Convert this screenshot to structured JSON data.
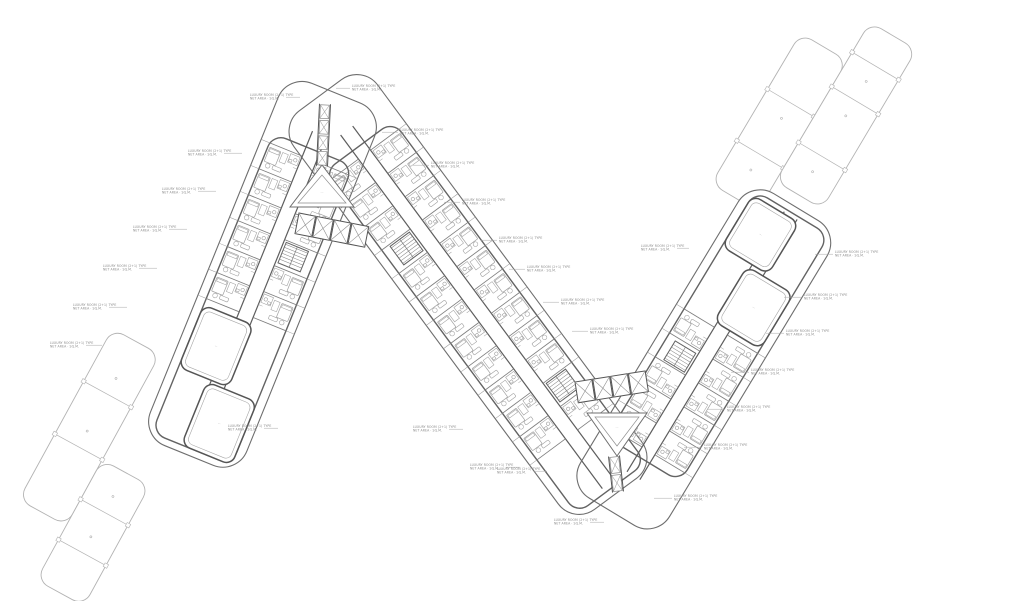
{
  "sheet": {
    "width": 1024,
    "height": 601,
    "background": "#ffffff",
    "kind": "residential-typical-floor-plan"
  },
  "palette": {
    "outline": "#6e6e6e",
    "wall": "#636363",
    "wall_heavy": "#555555",
    "corridor": "#5d5d5d",
    "partition": "#7e7e7e",
    "furniture": "#a0a0a0",
    "balcony": "#939393",
    "ghost": "#b3b3b3",
    "courtyard": "#6f6f6f",
    "annotation_text": "#8c8c8c",
    "leader": "#a8a8a8",
    "paper": "#ffffff"
  },
  "annotation_text": {
    "line1": "LUXURY ROOM (2+1) TYPE",
    "line2": "NET AREA · SQ.M."
  },
  "room_mark": "·–·",
  "ghosts": [
    {
      "id": "ghost-building-northeast",
      "origin": [
        762,
        208
      ],
      "angle": 210.7,
      "strips": [
        {
          "x": 2,
          "w": 54,
          "y0": -5,
          "y1": 170,
          "dividers": [
            45,
            105
          ]
        },
        {
          "x": -52,
          "w": 54,
          "y0": 30,
          "y1": 215,
          "dividers": [
            75,
            140,
            180
          ]
        }
      ]
    },
    {
      "id": "ghost-building-southwest",
      "origin": [
        140,
        395
      ],
      "angle": 28.7,
      "strips": [
        {
          "x": -56,
          "w": 54,
          "y0": -45,
          "y1": 150,
          "dividers": [
            15,
            75
          ]
        },
        {
          "x": -2,
          "w": 54,
          "y0": 75,
          "y1": 212,
          "dividers": [
            120,
            166
          ]
        }
      ]
    }
  ],
  "wings": [
    {
      "id": "middle-wing",
      "origin": [
        330,
        108
      ],
      "angle": -36.5,
      "length": 480,
      "half_width": 52,
      "corridor": [
        28,
        468
      ],
      "units": {
        "start": 58,
        "end": 406,
        "step": 29
      },
      "stairs": [
        {
          "side": -1,
          "t": 145
        },
        {
          "side": 1,
          "t": 348
        }
      ],
      "amenity": []
    },
    {
      "id": "left-wing",
      "origin": [
        330,
        108
      ],
      "angle": 22.09,
      "length": 375,
      "half_width": 52,
      "corridor": [
        28,
        363
      ],
      "units": {
        "start": 55,
        "end": 223,
        "step": 28
      },
      "stairs": [
        {
          "side": 1,
          "t": 148
        }
      ],
      "amenity": [
        {
          "x": -43,
          "y": 230,
          "w": 54,
          "h": 67
        },
        {
          "x": -11,
          "y": 300,
          "w": 54,
          "h": 68
        }
      ]
    },
    {
      "id": "right-wing",
      "origin": [
        620,
        498
      ],
      "angle": 211.15,
      "length": 340,
      "half_width": 52,
      "corridor": [
        26,
        330
      ],
      "units": {
        "start": 55,
        "end": 195,
        "step": 28
      },
      "stairs": [
        {
          "side": 1,
          "t": 150
        }
      ],
      "amenity": [
        {
          "x": -43,
          "y": 200,
          "w": 54,
          "h": 64
        },
        {
          "x": -11,
          "y": 268,
          "w": 54,
          "h": 60
        }
      ]
    }
  ],
  "junctions": [
    {
      "id": "top-junction-core",
      "triangle": [
        [
          322,
          165
        ],
        [
          290,
          207
        ],
        [
          354,
          207
        ]
      ],
      "triangle_inner": [
        [
          322,
          175
        ],
        [
          298,
          203
        ],
        [
          346,
          203
        ]
      ],
      "mark": [
        322,
        193
      ],
      "elevators": {
        "origin": [
          299,
          213
        ],
        "angle": 11,
        "count": 4,
        "w": 17,
        "h": 21,
        "gap": 1
      },
      "shaft": {
        "from": [
          325,
          104
        ],
        "to": [
          322,
          166
        ],
        "boxes": 4
      }
    },
    {
      "id": "bottom-junction-core",
      "triangle": [
        [
          617,
          456
        ],
        [
          587,
          413
        ],
        [
          647,
          413
        ]
      ],
      "triangle_inner": [
        [
          617,
          446
        ],
        [
          595,
          417
        ],
        [
          639,
          417
        ]
      ],
      "mark": [
        617,
        428
      ],
      "elevators": {
        "origin": [
          575,
          382
        ],
        "angle": -9,
        "count": 4,
        "w": 17,
        "h": 21,
        "gap": 1
      },
      "shaft": {
        "from": [
          614,
          456
        ],
        "to": [
          618,
          492
        ],
        "boxes": 2
      }
    }
  ],
  "annotations": [
    {
      "x": 250,
      "y": 96,
      "dir": "R",
      "len": 14
    },
    {
      "x": 188,
      "y": 152,
      "dir": "R",
      "len": 18
    },
    {
      "x": 162,
      "y": 190,
      "dir": "R",
      "len": 18
    },
    {
      "x": 133,
      "y": 228,
      "dir": "R",
      "len": 18
    },
    {
      "x": 103,
      "y": 267,
      "dir": "R",
      "len": 18
    },
    {
      "x": 73,
      "y": 306,
      "dir": "R",
      "len": 18
    },
    {
      "x": 50,
      "y": 344,
      "dir": "R",
      "len": 16
    },
    {
      "x": 228,
      "y": 427,
      "dir": "R",
      "len": 14
    },
    {
      "x": 352,
      "y": 87,
      "dir": "L",
      "len": 14
    },
    {
      "x": 400,
      "y": 131,
      "dir": "L",
      "len": 16
    },
    {
      "x": 431,
      "y": 164,
      "dir": "L",
      "len": 16
    },
    {
      "x": 462,
      "y": 201,
      "dir": "L",
      "len": 16
    },
    {
      "x": 499,
      "y": 239,
      "dir": "L",
      "len": 16
    },
    {
      "x": 527,
      "y": 268,
      "dir": "L",
      "len": 16
    },
    {
      "x": 561,
      "y": 301,
      "dir": "L",
      "len": 16
    },
    {
      "x": 590,
      "y": 330,
      "dir": "L",
      "len": 16
    },
    {
      "x": 641,
      "y": 247,
      "dir": "R",
      "len": 12
    },
    {
      "x": 835,
      "y": 253,
      "dir": "L",
      "len": 18
    },
    {
      "x": 804,
      "y": 296,
      "dir": "L",
      "len": 18
    },
    {
      "x": 786,
      "y": 332,
      "dir": "L",
      "len": 18
    },
    {
      "x": 751,
      "y": 371,
      "dir": "L",
      "len": 18
    },
    {
      "x": 727,
      "y": 408,
      "dir": "L",
      "len": 18
    },
    {
      "x": 704,
      "y": 446,
      "dir": "L",
      "len": 18
    },
    {
      "x": 674,
      "y": 497,
      "dir": "L",
      "len": 18
    },
    {
      "x": 554,
      "y": 521,
      "dir": "R",
      "len": 14
    },
    {
      "x": 497,
      "y": 470,
      "dir": "R",
      "len": 14
    },
    {
      "x": 413,
      "y": 428,
      "dir": "R",
      "len": 14
    },
    {
      "x": 470,
      "y": 466,
      "dir": "R",
      "len": 14
    }
  ]
}
